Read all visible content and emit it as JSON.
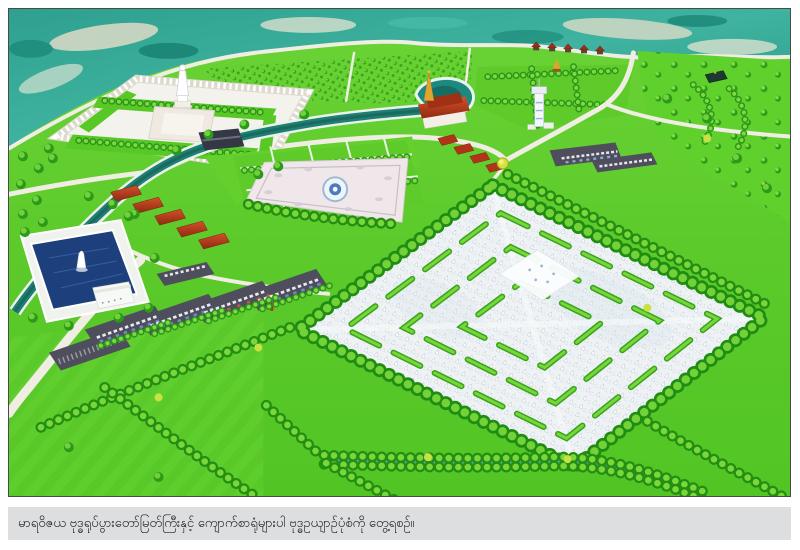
{
  "figure": {
    "caption": "မာရဝိဇယ ဗုဒ္ဓရုပ်ပွားတော်မြတ်ကြီးနှင့် ကျောက်စာရုံများပါ ဗုဒ္ဓဥယျာဉ်ပုံစံကို တွေ့ရစဉ်။"
  },
  "colors": {
    "caption_bar": "#dcdee0",
    "caption_text": "#1d1d1f",
    "grass": "#5bc92a",
    "grass_light": "#6bd335",
    "tree_dark": "#1f8c12",
    "tree_light": "#72d238",
    "canal_water": "#1e7f72",
    "pond_water": "#1d3f7c",
    "terrain_teal": "#2fa08f",
    "terrain_sand": "#e7dfc9",
    "plaza": "#efe7ea",
    "road": "#f0ede3",
    "asphalt": "#4e4e5c",
    "roof_red": "#b23418",
    "gold": "#e0a52f",
    "stupa_white": "#ffffff"
  }
}
